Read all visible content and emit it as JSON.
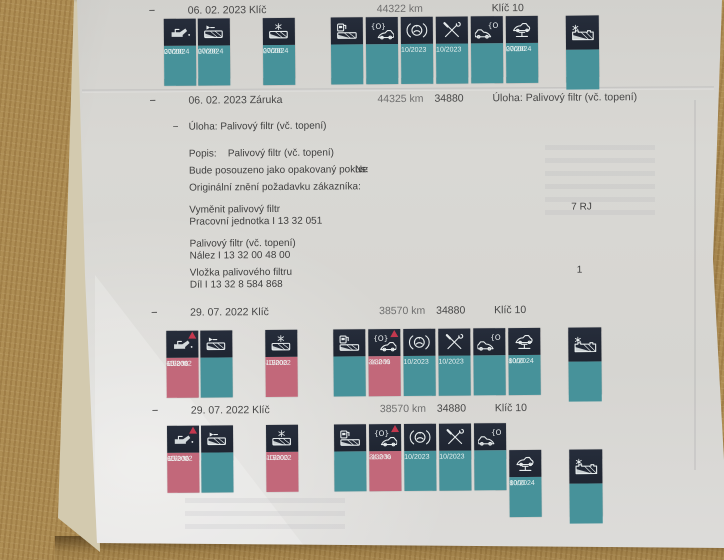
{
  "colors": {
    "badge_dark": "#1f2531",
    "teal": "#47929a",
    "pink": "#c2687a",
    "warning": "#c4384e",
    "paper": "#d8d6d2",
    "desk": "#a9884f"
  },
  "records": [
    {
      "dash": "−",
      "date": "06. 02. 2023",
      "kind": "Klíč",
      "km": "44322 km",
      "code": "",
      "label": "Klíč 10",
      "groups": [
        [
          {
            "icon": "oil-can",
            "tone": "teal",
            "warn": false,
            "lines": [
              "20000",
              "",
              "07/2024"
            ]
          },
          {
            "icon": "exhaust-filter",
            "tone": "teal",
            "warn": false,
            "lines": [
              "20000",
              "",
              "07/2024"
            ]
          }
        ],
        [
          {
            "icon": "pollen-filter",
            "tone": "teal",
            "warn": false,
            "lines": [
              "20000",
              "",
              "07/2024"
            ]
          }
        ],
        [
          {
            "icon": "fuel-filter",
            "tone": "teal",
            "warn": false,
            "lines": [
              "",
              "",
              ""
            ]
          },
          {
            "icon": "brake-pads-car",
            "tone": "teal",
            "warn": false,
            "lines": [
              "",
              "",
              ""
            ]
          },
          {
            "icon": "brake-disc",
            "tone": "teal",
            "warn": false,
            "lines": [
              "",
              "",
              "10/2023"
            ]
          },
          {
            "icon": "service-tools",
            "tone": "teal",
            "warn": false,
            "lines": [
              "",
              "",
              "10/2023"
            ]
          },
          {
            "icon": "brake-pads-car-right",
            "tone": "teal",
            "warn": false,
            "lines": [
              "",
              "",
              ""
            ]
          },
          {
            "icon": "car-lift",
            "tone": "teal",
            "warn": false,
            "lines": [
              "20000",
              "",
              "07/2024"
            ]
          }
        ],
        [
          {
            "icon": "battery-cold",
            "tone": "teal",
            "warn": false,
            "wide": true,
            "lines": [
              "",
              "",
              ""
            ]
          }
        ]
      ]
    },
    {
      "dash": "−",
      "date": "06. 02. 2023",
      "kind": "Záruka",
      "km": "44325 km",
      "code": "34880",
      "label": "Úloha: Palivový filtr (vč. topení)",
      "groups": []
    },
    {
      "dash": "−",
      "date": "29. 07. 2022",
      "kind": "Klíč",
      "km": "38570 km",
      "code": "34880",
      "label": "Klíč 10",
      "groups": [
        [
          {
            "icon": "oil-can",
            "tone": "pink",
            "warn": true,
            "lines": [
              "-15000",
              "65.2 %",
              "10/2022"
            ]
          },
          {
            "icon": "exhaust-filter",
            "tone": "teal",
            "warn": false,
            "lines": [
              "",
              "",
              ""
            ]
          }
        ],
        [
          {
            "icon": "pollen-filter",
            "tone": "pink",
            "warn": false,
            "lines": [
              "-15000",
              "",
              "10/2022"
            ]
          }
        ],
        [
          {
            "icon": "fuel-filter",
            "tone": "teal",
            "warn": false,
            "lines": [
              "",
              "",
              ""
            ]
          },
          {
            "icon": "brake-pads-car",
            "tone": "pink",
            "warn": true,
            "lines": [
              "-13000",
              "34.2 %",
              ""
            ]
          },
          {
            "icon": "brake-disc",
            "tone": "teal",
            "warn": false,
            "lines": [
              "",
              "",
              "10/2023"
            ]
          },
          {
            "icon": "service-tools",
            "tone": "teal",
            "warn": false,
            "lines": [
              "",
              "",
              "10/2023"
            ]
          },
          {
            "icon": "brake-pads-car-right",
            "tone": "teal",
            "warn": false,
            "lines": [
              "",
              "",
              ""
            ]
          },
          {
            "icon": "car-lift",
            "tone": "teal",
            "warn": false,
            "lines": [
              "8000",
              "",
              "10/2024"
            ]
          }
        ],
        [
          {
            "icon": "battery-cold",
            "tone": "teal",
            "warn": false,
            "wide": true,
            "lines": [
              "",
              "",
              ""
            ]
          }
        ]
      ]
    },
    {
      "dash": "−",
      "date": "29. 07. 2022",
      "kind": "Klíč",
      "km": "38570 km",
      "code": "34880",
      "label": "Klíč 10",
      "groups": [
        [
          {
            "icon": "oil-can",
            "tone": "pink",
            "warn": true,
            "lines": [
              "-15000",
              "65.2 %",
              "10/2022"
            ]
          },
          {
            "icon": "exhaust-filter",
            "tone": "teal",
            "warn": false,
            "lines": [
              "",
              "",
              ""
            ]
          }
        ],
        [
          {
            "icon": "pollen-filter",
            "tone": "pink",
            "warn": false,
            "lines": [
              "-15000",
              "",
              "10/2022"
            ]
          }
        ],
        [
          {
            "icon": "fuel-filter",
            "tone": "teal",
            "warn": false,
            "lines": [
              "",
              "",
              ""
            ]
          },
          {
            "icon": "brake-pads-car",
            "tone": "pink",
            "warn": true,
            "lines": [
              "-13000",
              "34.2 %",
              ""
            ]
          },
          {
            "icon": "brake-disc",
            "tone": "teal",
            "warn": false,
            "lines": [
              "",
              "",
              "10/2023"
            ]
          },
          {
            "icon": "service-tools",
            "tone": "teal",
            "warn": false,
            "lines": [
              "",
              "",
              "10/2023"
            ]
          },
          {
            "icon": "brake-pads-car-right",
            "tone": "teal",
            "warn": false,
            "lines": [
              "",
              "",
              ""
            ]
          },
          {
            "icon": "car-lift",
            "tone": "teal",
            "warn": false,
            "dropped": true,
            "lines": [
              "8000",
              "",
              "10/2024"
            ]
          }
        ],
        [
          {
            "icon": "battery-cold",
            "tone": "teal",
            "warn": false,
            "wide": true,
            "dropped": true,
            "lines": [
              "",
              "",
              ""
            ]
          }
        ]
      ]
    }
  ],
  "detail": {
    "dash": "−",
    "title": "Úloha: Palivový filtr (vč. topení)",
    "fields": [
      {
        "label": "Popis:",
        "value": "Palivový filtr (vč. topení)"
      },
      {
        "label": "Bude posouzeno jako opakovaný pokus:",
        "value": "Ne"
      },
      {
        "label": "Originální znění požadavku zákazníka:",
        "value": ""
      }
    ],
    "items": [
      {
        "line1": "Vyměnit palivový filtr",
        "line2": "Pracovní jednotka I 13 32 051",
        "qty": "7 RJ"
      },
      {
        "line1": "Palivový filtr (vč. topení)",
        "line2": "Nález I 13 32 00 48 00",
        "qty": ""
      },
      {
        "line1": "Vložka palivového filtru",
        "line2": "Díl I 13 32 8 584 868",
        "qty": "1"
      }
    ]
  }
}
